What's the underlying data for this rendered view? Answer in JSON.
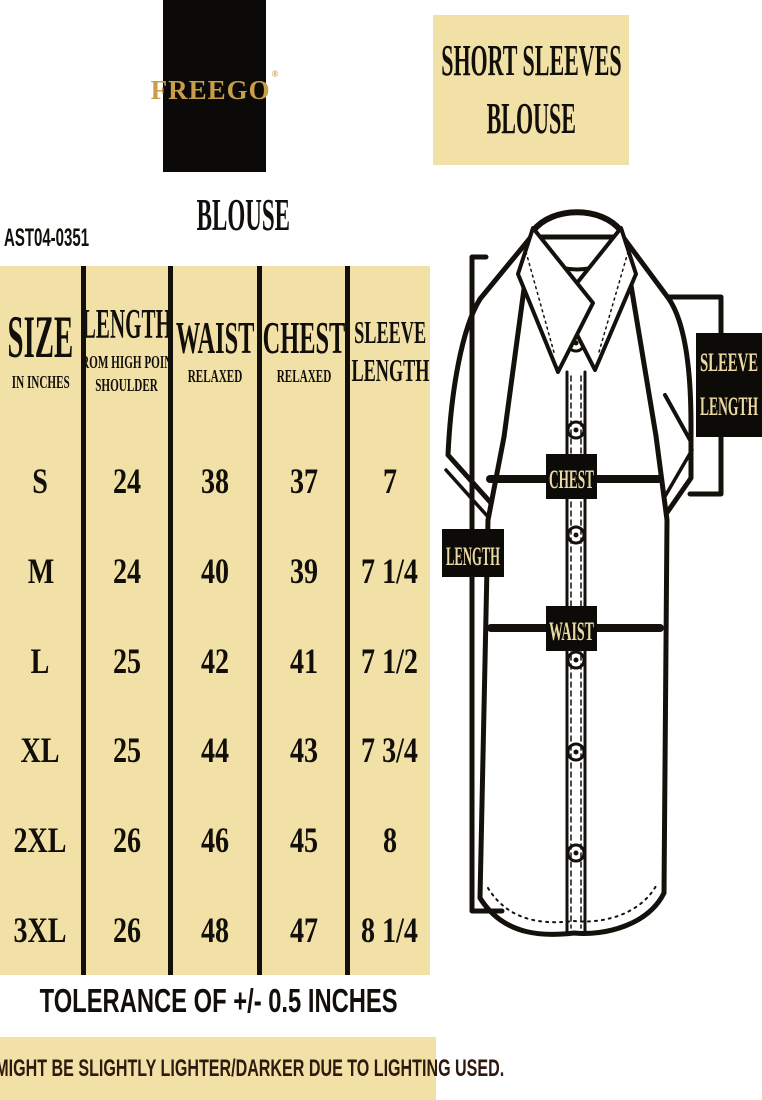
{
  "brand": {
    "logo_text": "FREEGO",
    "registered_mark": "®",
    "product_heading": "BLOUSE",
    "sku": "AST04-0351"
  },
  "title": {
    "line1": "SHORT SLEEVES",
    "line2": "BLOUSE"
  },
  "size_chart": {
    "columns": [
      {
        "label": "SIZE",
        "label2": "",
        "sub1": "IN INCHES",
        "sub2": ""
      },
      {
        "label": "LENGTH",
        "label2": "",
        "sub1": "FROM HIGH POINT",
        "sub2": "SHOULDER"
      },
      {
        "label": "WAIST",
        "label2": "",
        "sub1": "RELAXED",
        "sub2": ""
      },
      {
        "label": "CHEST",
        "label2": "",
        "sub1": "RELAXED",
        "sub2": ""
      },
      {
        "label": "SLEEVE",
        "label2": "LENGTH",
        "sub1": "",
        "sub2": ""
      }
    ],
    "rows": [
      {
        "size": "S",
        "length": "24",
        "waist": "38",
        "chest": "37",
        "sleeve": "7"
      },
      {
        "size": "M",
        "length": "24",
        "waist": "40",
        "chest": "39",
        "sleeve": "7 1/4"
      },
      {
        "size": "L",
        "length": "25",
        "waist": "42",
        "chest": "41",
        "sleeve": "7 1/2"
      },
      {
        "size": "XL",
        "length": "25",
        "waist": "44",
        "chest": "43",
        "sleeve": "7 3/4"
      },
      {
        "size": "2XL",
        "length": "26",
        "waist": "46",
        "chest": "45",
        "sleeve": "8"
      },
      {
        "size": "3XL",
        "length": "26",
        "waist": "48",
        "chest": "47",
        "sleeve": "8 1/4"
      }
    ]
  },
  "diagram": {
    "sleeve_line1": "SLEEVE",
    "sleeve_line2": "LENGTH",
    "chest": "CHEST",
    "length": "LENGTH",
    "waist": "WAIST"
  },
  "footer": {
    "tolerance": "TOLERANCE OF +/- 0.5 INCHES",
    "disclaimer": "COLOR MIGHT BE SLIGHTLY LIGHTER/DARKER DUE TO LIGHTING USED."
  },
  "colors": {
    "tan_background": "#f2e1a7",
    "ink_black": "#13100b",
    "logo_gold": "#c89e4a",
    "label_tan_text": "#ead9a2",
    "disclaimer_text": "#2e1a0e"
  }
}
